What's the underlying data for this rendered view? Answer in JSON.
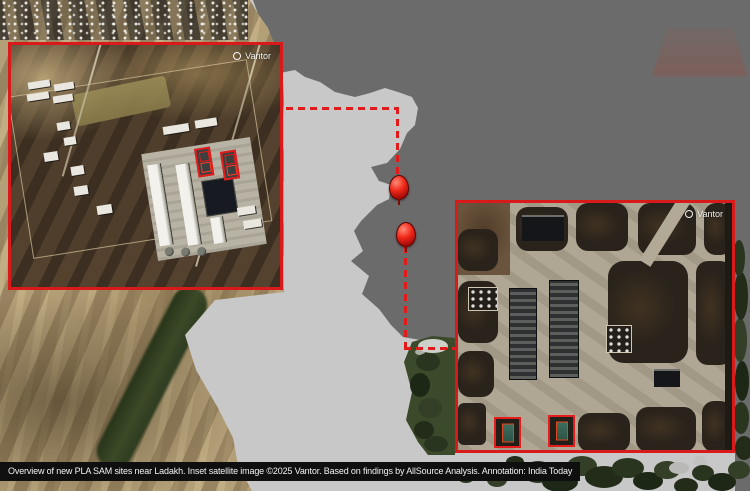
{
  "page": {
    "width": 750,
    "height": 491,
    "kind": "annotated satellite overview graphic"
  },
  "colors": {
    "annotation_red": "#e31a1a",
    "map_light_region": "#c8c8c8",
    "map_dark_region": "#6b6b6b",
    "caption_bg": "#0f0f0f",
    "caption_text": "#f2f2f2",
    "terrain_tan": "#b4a078",
    "valley_green": "#3c4a28"
  },
  "caption": {
    "text": "Overview of new PLA SAM sites near Ladakh. Inset satellite image ©2025 Vantor. Based on findings by AllSource Analysis. Annotation: India Today"
  },
  "insets": {
    "left": {
      "credit": "Vantor"
    },
    "right": {
      "credit": "Vantor"
    }
  },
  "markers": {
    "count": 2
  }
}
